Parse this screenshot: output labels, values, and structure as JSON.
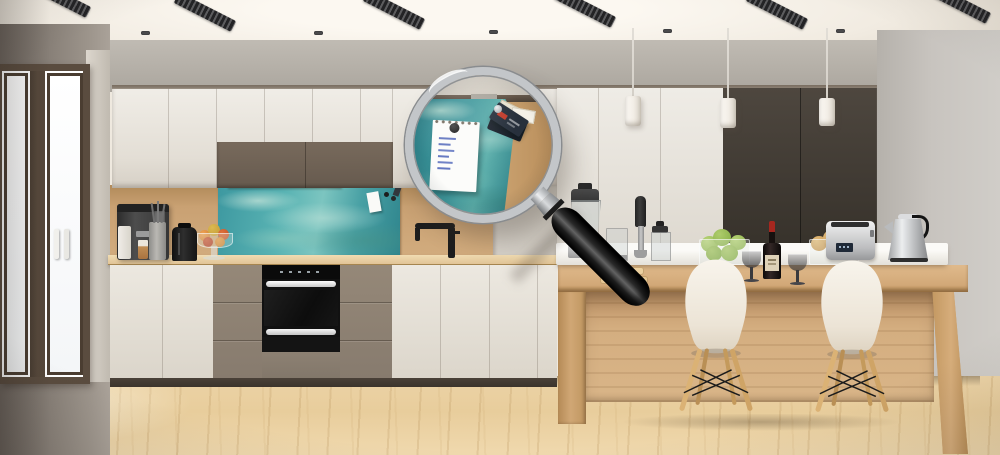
{
  "scene": {
    "type": "photograph",
    "subject": "Modern kitchen interior with a large magnifying glass revealing a close-up of the teal sea-glass magnetic splashback",
    "visible_text": "none (notepad handwriting is illegible blue scribbles)"
  },
  "palette": {
    "ceiling": "#f6f2ea",
    "back_wall": "#b3ada4",
    "right_wall": "#c6c2bc",
    "left_wall": "#8d857d",
    "cabinet_white": "#e9e5dd",
    "cabinet_taupe": "#8c8073",
    "cabinet_upper_brown": "#6e6154",
    "tall_panel_dark_brown": "#453e37",
    "splashback_teal": "#4aa2a8",
    "wood_wall": "#c7a173",
    "island_wood": "#d2a878",
    "countertop_wood": "#e2c79c",
    "floor_wood": "#ead1a1",
    "oven_black": "#111111",
    "magnifier_rim_silver": "#c3c6c9",
    "magnifier_handle_black": "#1a1a1a",
    "chair_shell_white": "#efe8dd",
    "chair_leg_wood": "#d6ab72",
    "wine_cap_red": "#a6271f",
    "apple_green": "#9dc157",
    "pear_tan": "#d3a45f",
    "notepad_ink_blue": "#6377c1",
    "ticket_red": "#c13b2b"
  },
  "objects": {
    "window": "french-door window with dark brown frame",
    "coffee_machine": "espresso machine",
    "utensil_crock": "utensil crock with whisks",
    "black_kettle": "black kettle",
    "fruit_stand": "fruit bowl on glass stand",
    "splashback": "teal sea-glass magnetic splashback",
    "pinned_card": "white card pinned with black magnets",
    "faucet": "black kitchen faucet",
    "oven": "built-in black oven with two white handles",
    "magnifier": "magnifying glass with black handle",
    "lens_view": "magnified splashback with spiral notepad, round magnet and ticket-stub magnets",
    "notepad": "spiral notepad with handwritten list",
    "handwritten_lines": 6,
    "tickets": "ticket-stub magnets",
    "pendants": "three white cylinder pendant lights",
    "tall_cabinets": "floor-to-ceiling cabinets, white and dark brown",
    "island": "wood and white kitchen island bar",
    "chairs": "two white shell chairs with wooden legs",
    "blender": "jug blender",
    "stick_blender": "immersion blender",
    "food_processor": "mini food processor",
    "apples_bowl": "glass bowl of green apples",
    "wine_bottle": "red wine bottle",
    "wine_glasses": "two smoked wine glasses",
    "pears_bowl": "glass bowl of pears",
    "toaster": "stainless steel toaster",
    "steel_kettle": "stainless steel kettle",
    "ceiling_vents": 6,
    "ceiling_spotlights": 5
  }
}
